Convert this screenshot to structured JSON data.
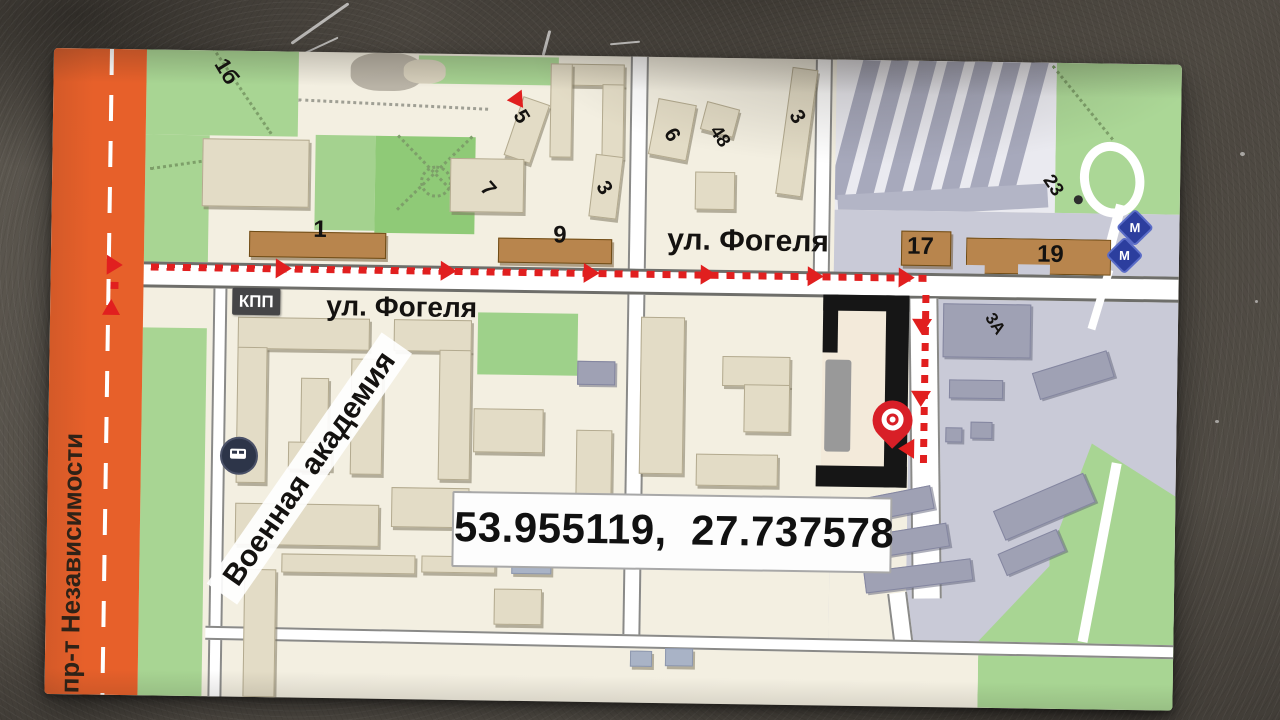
{
  "card": {
    "avenue_label": "пр-т Независимости",
    "street_label_left": "ул. Фогеля",
    "street_label_right": "ул. Фогеля",
    "checkpoint_label": "КПП",
    "academy_label": "Военная академия",
    "coordinates_text": "53.955119,  27.737578",
    "buildings": {
      "b1b": "1б",
      "b1": "1",
      "b9": "9",
      "b5": "5",
      "b7": "7",
      "b3_mid": "3",
      "b6": "6",
      "b48": "48",
      "b3_right": "3",
      "b17": "17",
      "b19": "19",
      "b23": "23",
      "b3a": "3А"
    },
    "icons": {
      "metro_glyph": "М"
    },
    "colors": {
      "stripe_orange": "#e7602a",
      "route_red": "#e11f1f",
      "park_green": "#a8d593",
      "building_beige": "#e3dcc6",
      "building_brown": "#b8854d",
      "campus_gray": "#c9cad7",
      "destination_black": "#161616",
      "pin_red": "#d81f27",
      "metro_blue": "#2c3e9e"
    }
  }
}
